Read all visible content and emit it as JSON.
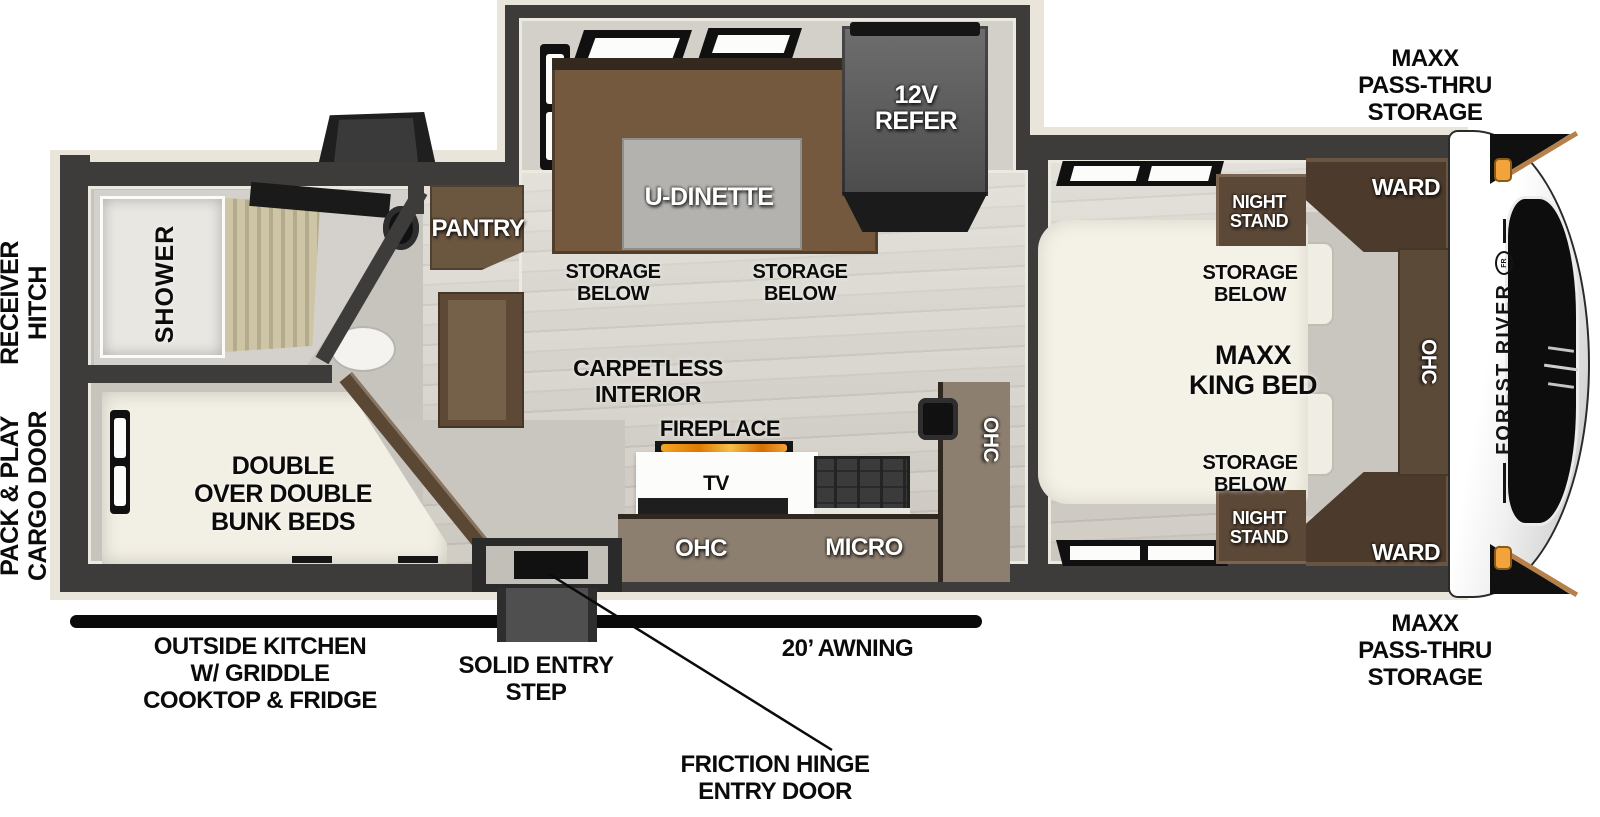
{
  "exterior": {
    "receiver_hitch": {
      "l1": "RECEIVER",
      "l2": "HITCH"
    },
    "cargo_door": {
      "l1": "PACK & PLAY",
      "l2": "CARGO DOOR"
    },
    "pass_thru": {
      "l1": "MAXX",
      "l2": "PASS-THRU",
      "l3": "STORAGE"
    },
    "outside_kitchen": {
      "l1": "OUTSIDE KITCHEN",
      "l2": "W/ GRIDDLE",
      "l3": "COOKTOP & FRIDGE"
    },
    "solid_entry_step": {
      "l1": "SOLID ENTRY",
      "l2": "STEP"
    },
    "awning": "20’ AWNING",
    "friction_hinge": {
      "l1": "FRICTION HINGE",
      "l2": "ENTRY DOOR"
    }
  },
  "front_cap": {
    "brand": "FOREST RIVER",
    "logo": "FR"
  },
  "bath": {
    "shower": "SHOWER"
  },
  "bunk": {
    "l1": "DOUBLE",
    "l2": "OVER DOUBLE",
    "l3": "BUNK BEDS"
  },
  "dinette": {
    "label": "U-DINETTE",
    "refer": {
      "l1": "12V",
      "l2": "REFER"
    },
    "pantry": "PANTRY",
    "storage_below": {
      "l1": "STORAGE",
      "l2": "BELOW"
    }
  },
  "kitchen": {
    "carpetless": {
      "l1": "CARPETLESS",
      "l2": "INTERIOR"
    },
    "fireplace": "FIREPLACE",
    "tv": "TV",
    "ohc": "OHC",
    "micro": "MICRO"
  },
  "bedroom": {
    "bed": {
      "l1": "MAXX",
      "l2": "KING BED"
    },
    "storage_below": {
      "l1": "STORAGE",
      "l2": "BELOW"
    },
    "night_stand": {
      "l1": "NIGHT",
      "l2": "STAND"
    },
    "ward": "WARD",
    "ohc": "OHC"
  },
  "colors": {
    "wall": "#3e3c3a",
    "trim": "#e9e5da",
    "cabinet": "#6b5640",
    "flame": "#e8920f",
    "marker_light": "#f2a33c"
  }
}
